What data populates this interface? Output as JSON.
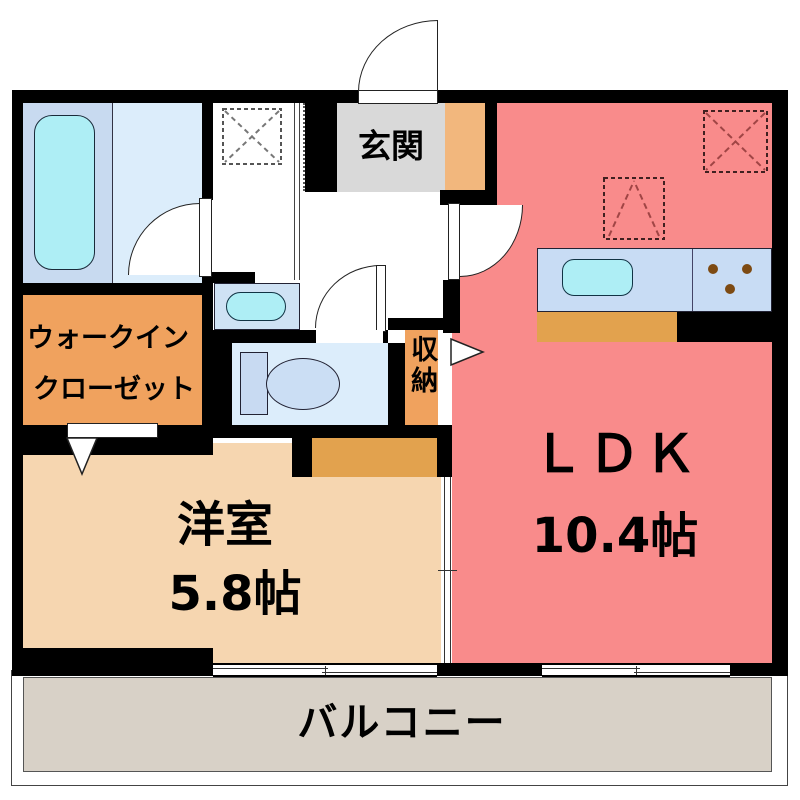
{
  "plan": {
    "entrance": {
      "label": "玄関"
    },
    "ldk": {
      "name": "ＬＤＫ",
      "size": "10.4帖"
    },
    "western_room": {
      "name": "洋室",
      "size": "5.8帖"
    },
    "walk_in_closet": {
      "line1": "ウォークイン",
      "line2": "クローゼット"
    },
    "storage": {
      "label": "収納"
    },
    "balcony": {
      "label": "バルコニー"
    },
    "colors": {
      "wall": "#000000",
      "ldk_pink": "#f98b8b",
      "western_beige": "#f6d6b0",
      "closet_orange": "#f0a25e",
      "shoe_cabinet_orange": "#f2b77d",
      "kitchen_base_orange": "#e2a24e",
      "balcony_gray": "#d8d1c7",
      "entrance_gray": "#d9d9d9",
      "bath_blue": "#c8daf0",
      "room_blue": "#dcedfb",
      "fixture_cyan": "#aeeef5",
      "counter_blue": "#c8dcf4",
      "stove_brown": "#7d4a12"
    }
  }
}
